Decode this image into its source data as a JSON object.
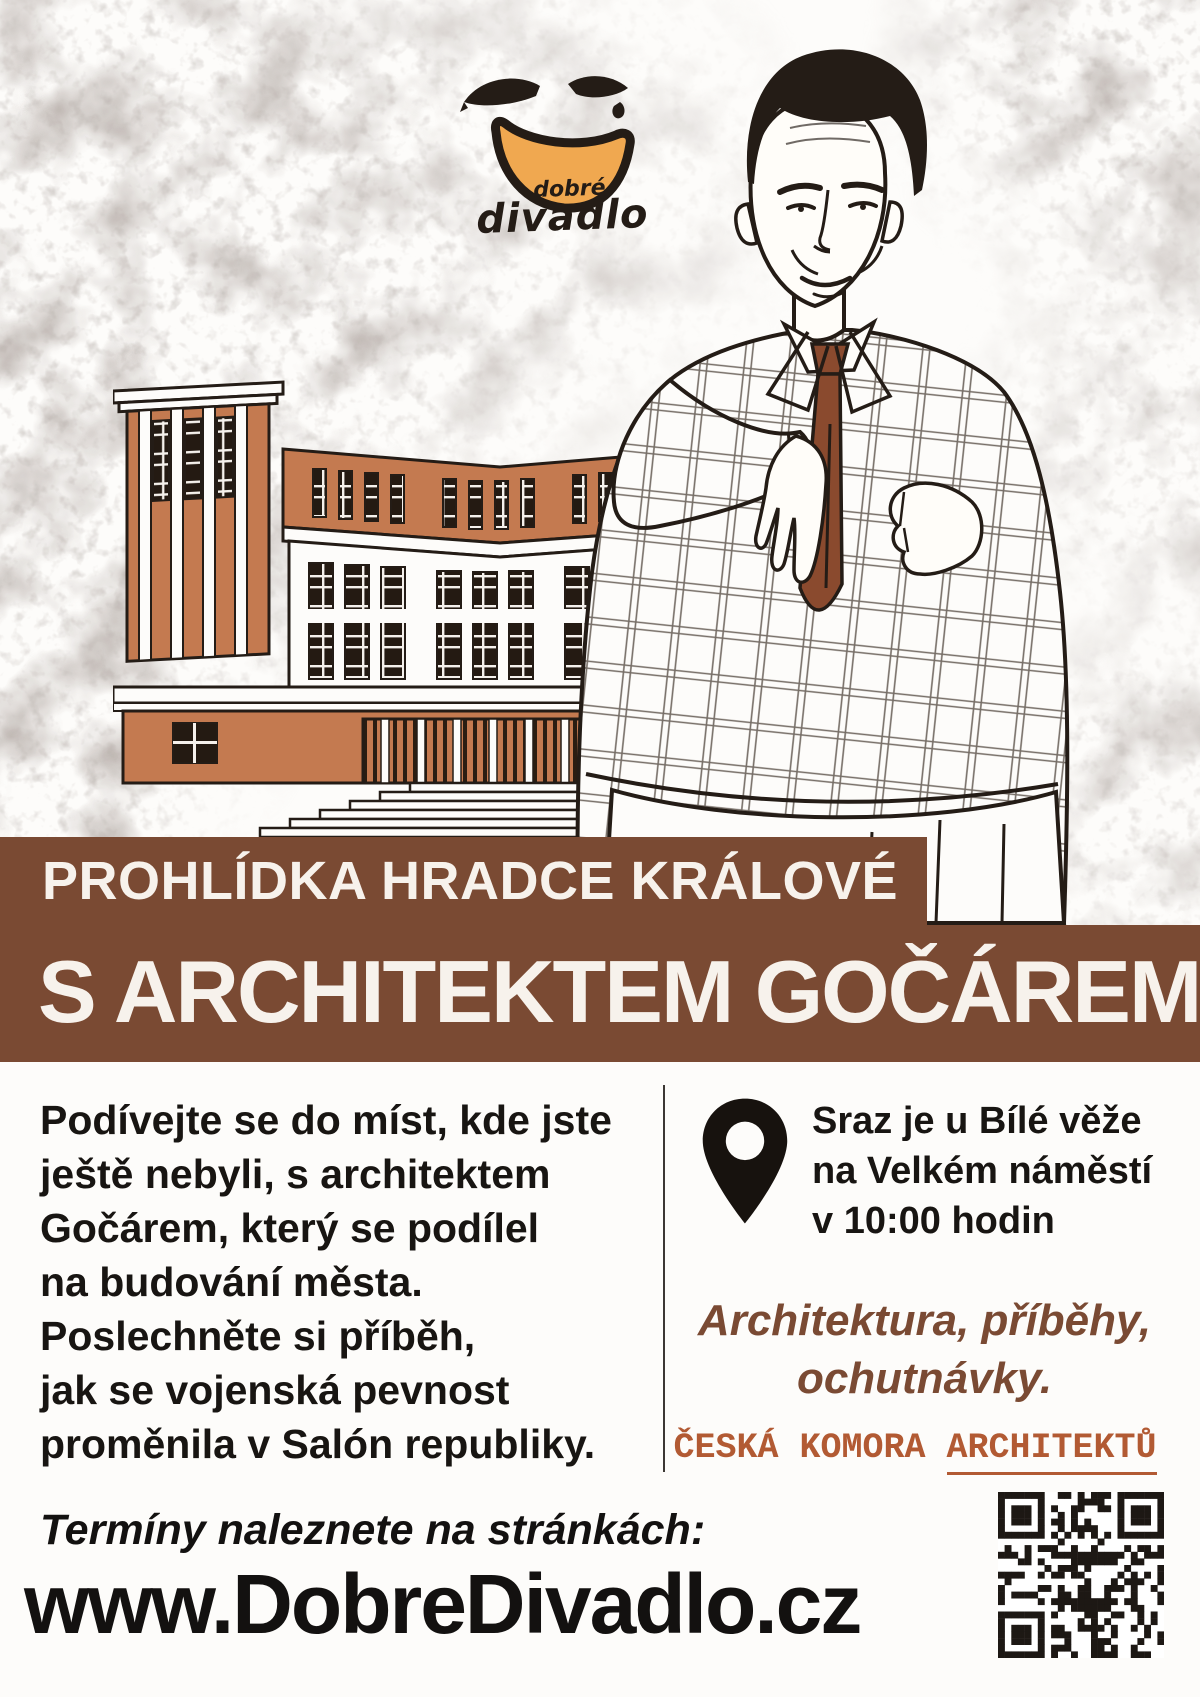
{
  "poster": {
    "logo": {
      "word_small": "dobré",
      "word_large": "divadlo"
    },
    "banner": {
      "line1": "PROHLÍDKA HRADCE KRÁLOVÉ",
      "line2": "S ARCHITEKTEM GOČÁREM"
    },
    "description": {
      "lines": [
        "Podívejte se do míst, kde jste",
        "ještě nebyli, s architektem",
        "Gočárem, který se podílel",
        "na budování města.",
        "Poslechněte si příběh,",
        "jak se vojenská pevnost",
        "proměnila v Salón republiky."
      ]
    },
    "meeting": {
      "lines": [
        "Sraz je u Bílé věže",
        "na Velkém náměstí",
        "v 10:00 hodin"
      ]
    },
    "tagline": {
      "lines": [
        "Architektura, příběhy,",
        "ochutnávky."
      ]
    },
    "partner": {
      "prefix": "ČESKÁ KOMORA ",
      "underlined": "ARCHITEKTŮ"
    },
    "footer": {
      "note": "Termíny naleznete na stránkách:",
      "url": "www.DobreDivadlo.cz"
    },
    "colors": {
      "banner_brown": "#7a4a33",
      "terracotta": "#c47a50",
      "ink": "#241c16",
      "logo_orange": "#f0a850",
      "tie_brown": "#8a4a2e",
      "partner_orange": "#b25a33",
      "texture_gray": "#b3aaa5"
    }
  }
}
